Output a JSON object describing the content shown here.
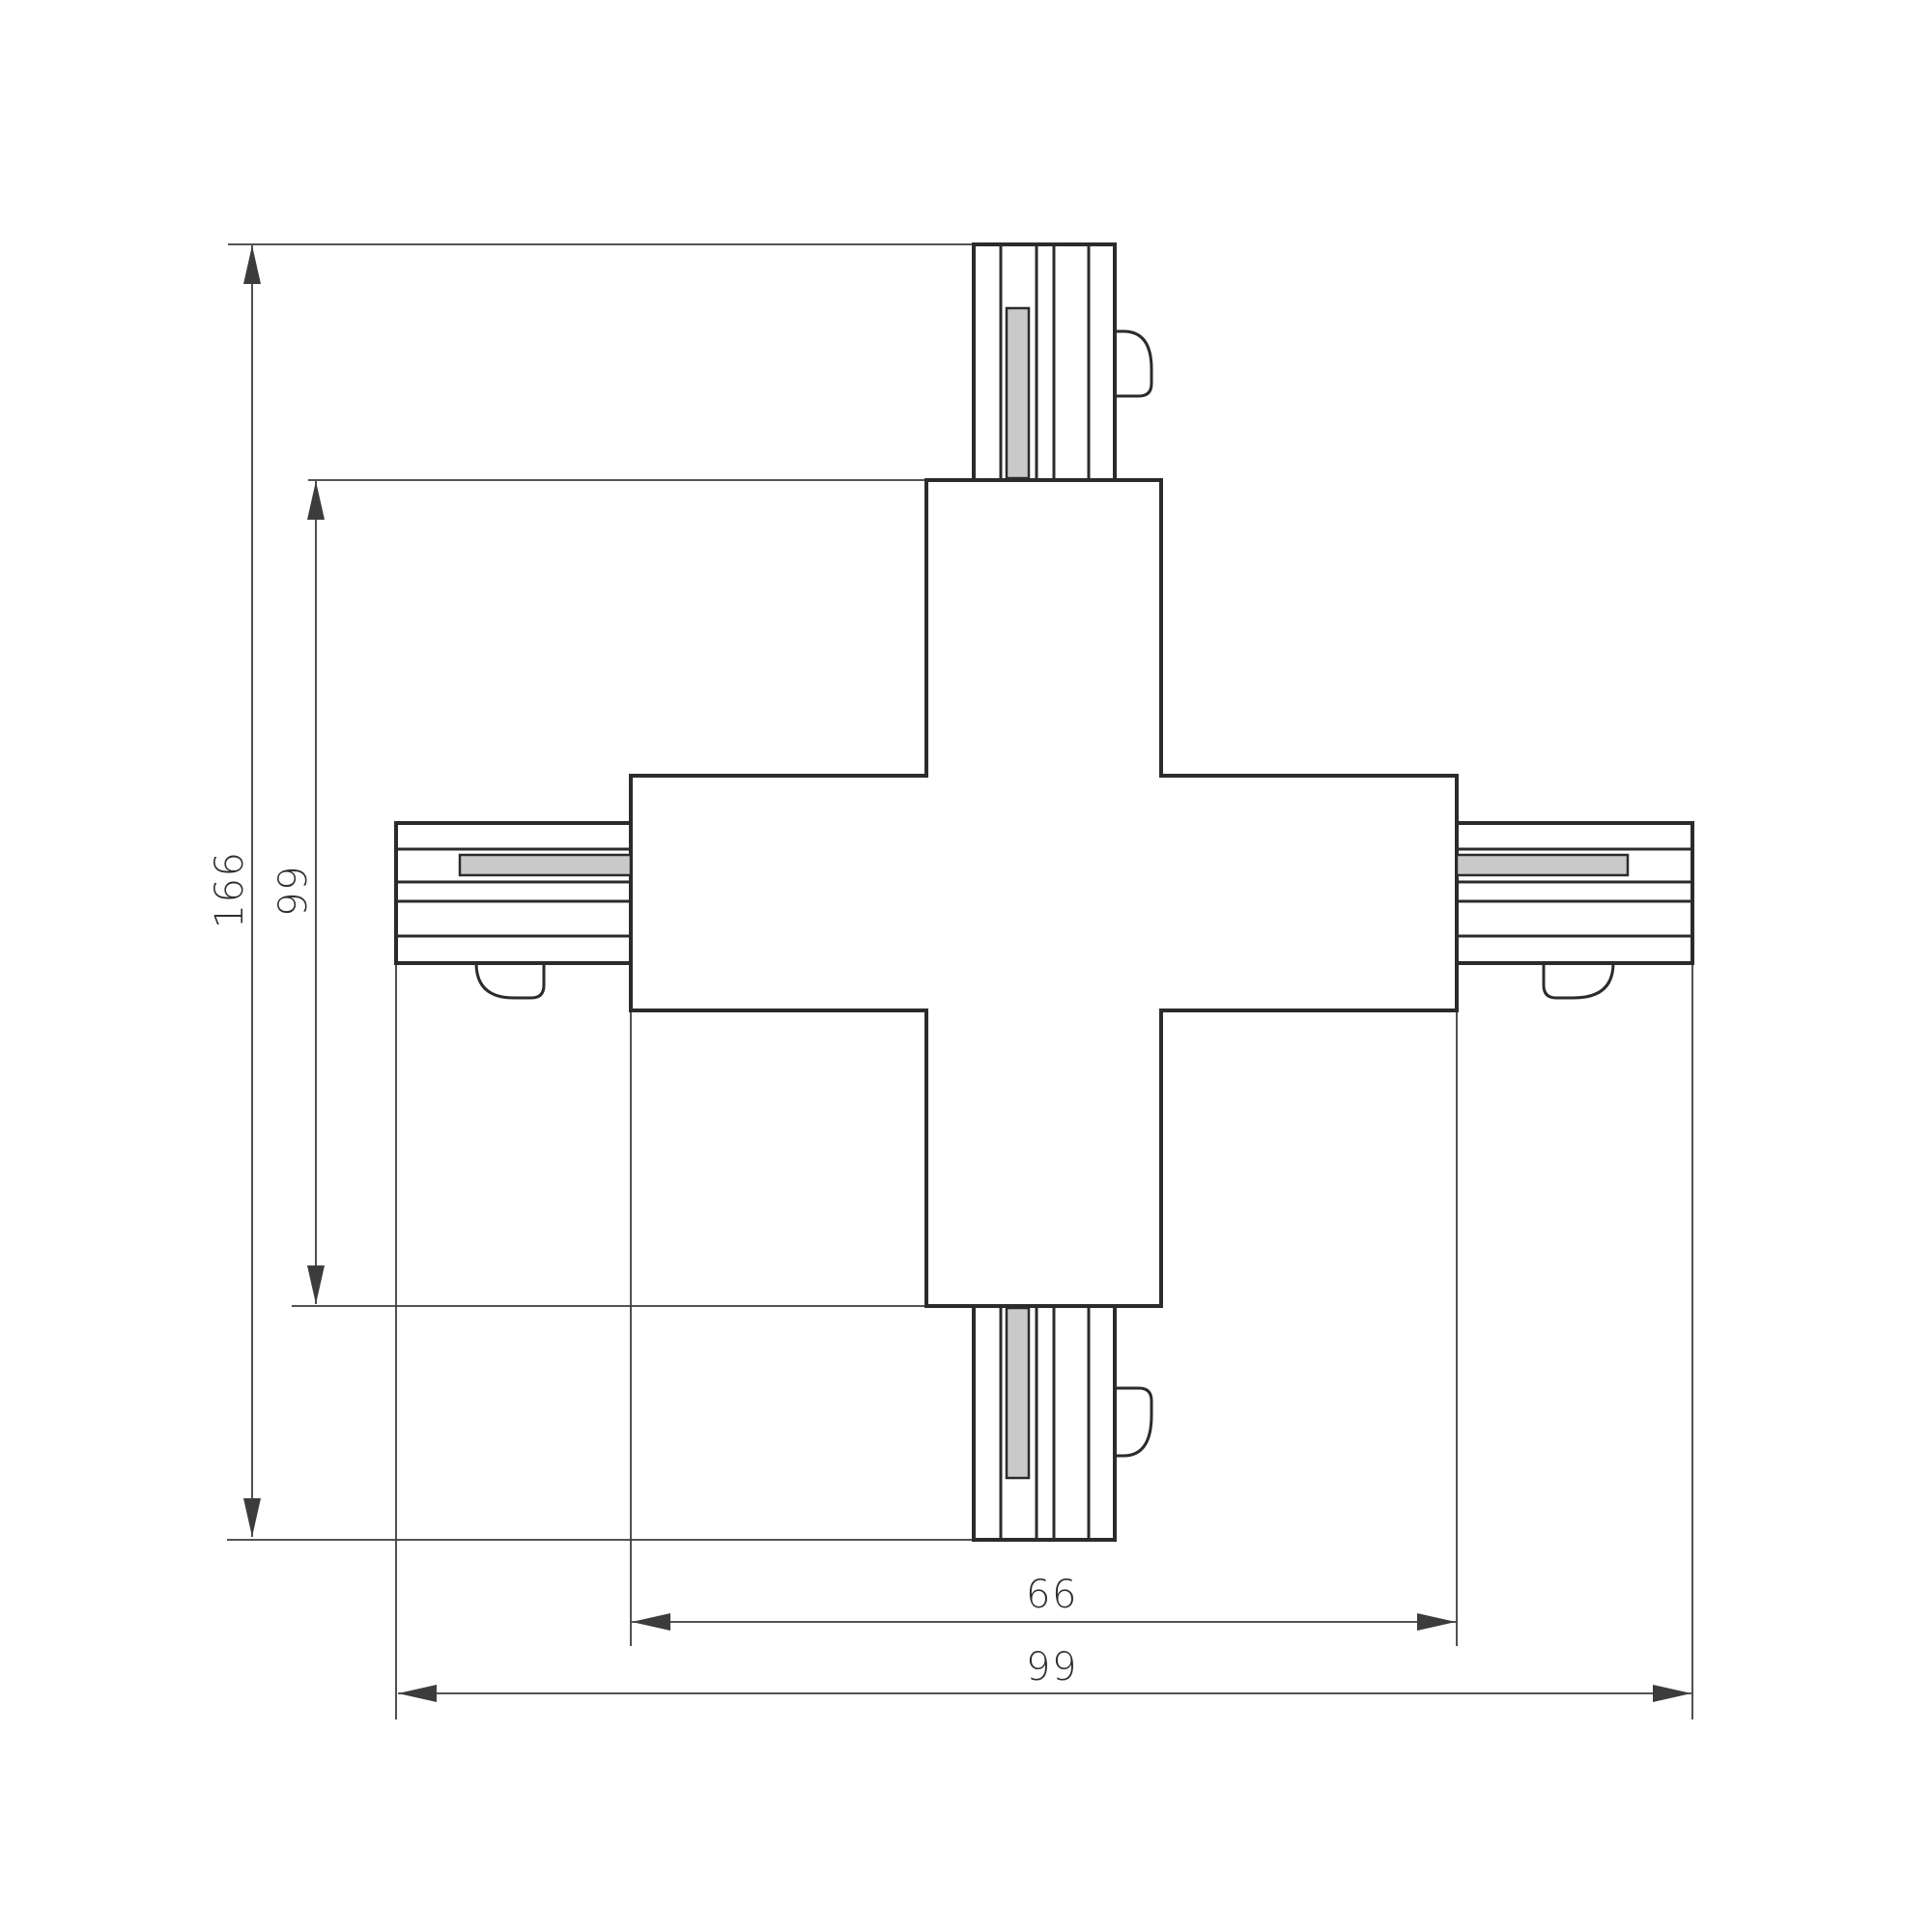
{
  "figure": {
    "type": "technical-drawing",
    "subject": "X-shaped track connector, plan view with dimensions"
  },
  "dims": {
    "outer_height": "166",
    "body_height": "99",
    "body_width": "66",
    "outer_width": "99"
  },
  "colors": {
    "line": "#2b2b2b",
    "dim": "#3c3c3c",
    "strip": "#c9c9c9",
    "bg": "#ffffff",
    "text": "#2f2f2f"
  }
}
